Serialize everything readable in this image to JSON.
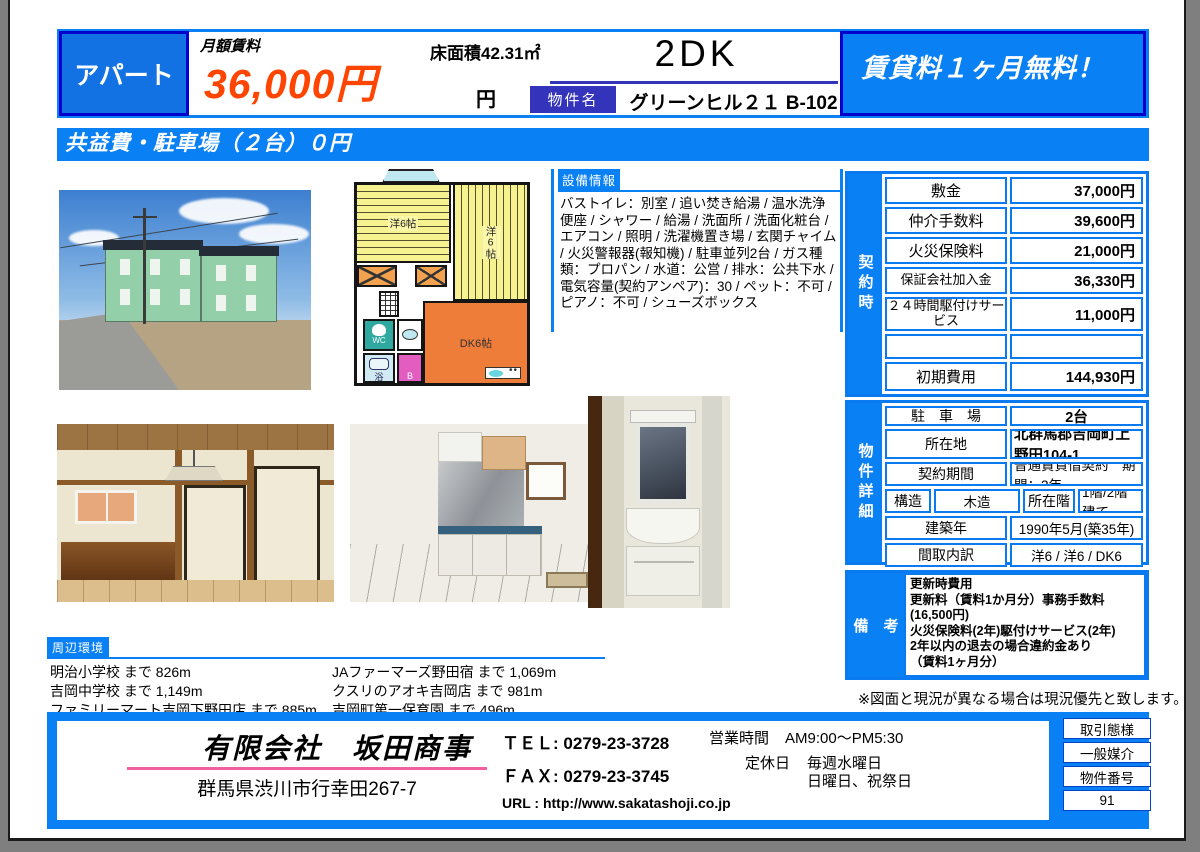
{
  "colors": {
    "accent_blue": "#0a80f5",
    "deep_blue": "#0000cc",
    "tag_navy": "#3333bb",
    "rent_orange": "#ff4500",
    "pink_underline": "#f0609e"
  },
  "header": {
    "property_type": "アパート",
    "rent_label": "月額賃料",
    "rent_value": "36,000円",
    "floor_area": "床面積42.31㎡",
    "yen": "円",
    "layout": "2DK",
    "name_label": "物件名",
    "property_name": "グリーンヒル２１ B-102",
    "promo": "賃貸料１ヶ月無料！"
  },
  "banner": "共益費・駐車場（２台）０円",
  "equipment": {
    "tag": "設備情報",
    "text": "バストイレ：別室 / 追い焚き給湯 / 温水洗浄便座 / シャワー / 給湯 / 洗面所 / 洗面化粧台 / エアコン / 照明 / 洗濯機置き場 / 玄関チャイム / 火災警報器(報知機) / 駐車並列2台 / ガス種類：プロパン / 水道：公営 / 排水：公共下水 / 電気容量(契約アンペア)：30 / ペット：不可 / ピアノ：不可 / シューズボックス"
  },
  "floorplan": {
    "room1": "洋6帖",
    "room2": "洋6帖",
    "dk": "DK6帖",
    "wc": "WC",
    "bath": "浴",
    "b": "B"
  },
  "contract": {
    "side_label": "契約時",
    "rows": [
      {
        "label": "敷金",
        "value": "37,000円"
      },
      {
        "label": "仲介手数料",
        "value": "39,600円"
      },
      {
        "label": "火災保険料",
        "value": "21,000円"
      },
      {
        "label": "保証会社加入金",
        "value": "36,330円"
      },
      {
        "label": "２４時間駆付けサービス",
        "value": "11,000円"
      },
      {
        "label": "",
        "value": ""
      },
      {
        "label": "初期費用",
        "value": "144,930円"
      }
    ]
  },
  "details": {
    "side_label": "物件詳細",
    "parking_label": "駐　車　場",
    "parking_value": "2台",
    "address_label": "所在地",
    "address_value": "北群馬郡吉岡町上野田104-1",
    "term_label": "契約期間",
    "term_value": "普通賃貸借契約　期間：2年",
    "structure_label": "構造",
    "structure_value": "木造",
    "floor_label": "所在階",
    "floor_value": "1階/2階建て",
    "built_label": "建築年",
    "built_value": "1990年5月(築35年)",
    "layout_label": "間取内訳",
    "layout_value": "洋6 / 洋6 / DK6"
  },
  "remarks": {
    "side_label": "備　考",
    "lines": [
      "更新時費用",
      "更新料（賃料1か月分）事務手数料(16,500円)",
      "火災保険料(2年)駆付けサービス(2年)",
      "2年以内の退去の場合違約金あり",
      "（賃料1ヶ月分）"
    ]
  },
  "note": "※図面と現況が異なる場合は現況優先と致します。",
  "environment": {
    "tag": "周辺環境",
    "left": [
      "明治小学校 まで 826m",
      "吉岡中学校 まで 1,149m",
      "ファミリーマート吉岡下野田店 まで 885m"
    ],
    "right": [
      "JAファーマーズ野田宿 まで 1,069m",
      "クスリのアオキ吉岡店 まで 981m",
      "吉岡町第一保育園 まで 496m"
    ]
  },
  "footer": {
    "company": "有限会社　坂田商事",
    "address": "群馬県渋川市行幸田267-7",
    "tel": "ＴＥＬ: 0279-23-3728",
    "fax": "ＦＡＸ: 0279-23-3745",
    "url": "URL : http://www.sakatashoji.co.jp",
    "hours_label": "営業時間",
    "hours_value": "AM9:00～PM5:30",
    "closed_label": "定休日",
    "closed_value1": "毎週水曜日",
    "closed_value2": "日曜日、祝祭日",
    "deal_type_label": "取引態様",
    "deal_type_value": "一般媒介",
    "property_no_label": "物件番号",
    "property_no_value": "91"
  }
}
